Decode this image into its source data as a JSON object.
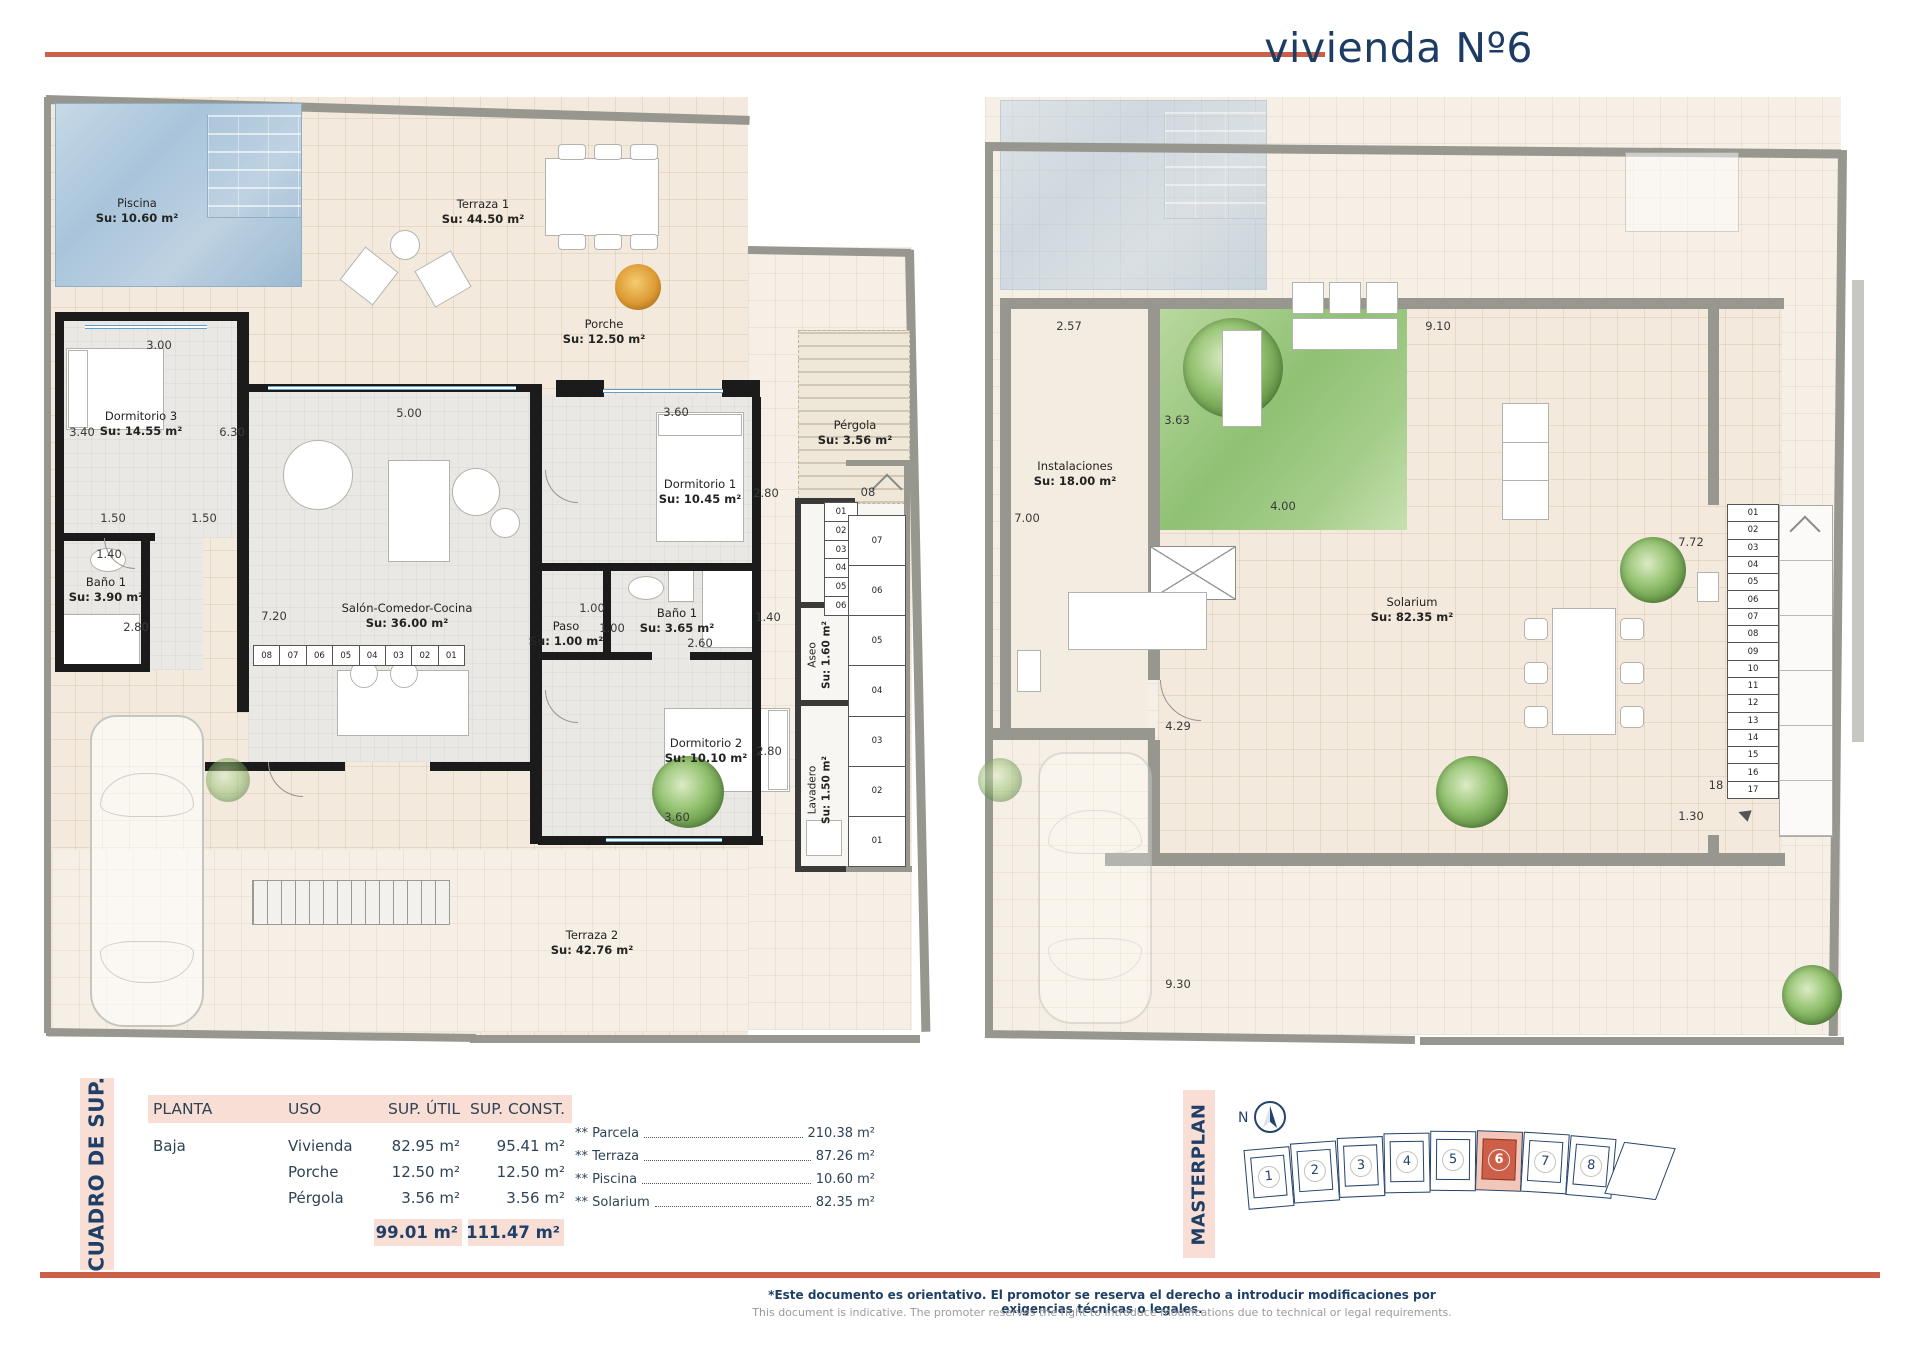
{
  "title": "vivienda Nº6",
  "colors": {
    "accent": "#cc5f48",
    "navy": "#1f3f66",
    "pink": "#f8ded4",
    "pool": "#a9c4da",
    "green": "#8fc173"
  },
  "left_plan": {
    "rooms": [
      {
        "name": "Piscina",
        "area": "Su: 10.60 m²"
      },
      {
        "name": "Terraza 1",
        "area": "Su: 44.50 m²"
      },
      {
        "name": "Porche",
        "area": "Su: 12.50 m²"
      },
      {
        "name": "Dormitorio 3",
        "area": "Su: 14.55 m²"
      },
      {
        "name": "Baño 1",
        "area": "Su: 3.90 m²"
      },
      {
        "name": "Salón-Comedor-Cocina",
        "area": "Su: 36.00 m²"
      },
      {
        "name": "Paso",
        "area": "Su: 1.00 m²"
      },
      {
        "name": "Baño 1",
        "area": "Su: 3.65 m²"
      },
      {
        "name": "Dormitorio 1",
        "area": "Su: 10.45 m²"
      },
      {
        "name": "Dormitorio 2",
        "area": "Su: 10.10 m²"
      },
      {
        "name": "Aseo",
        "area": "Su: 1.60 m²"
      },
      {
        "name": "Lavadero",
        "area": "Su: 1.50 m²"
      },
      {
        "name": "Pérgola",
        "area": "Su: 3.56 m²"
      },
      {
        "name": "Terraza 2",
        "area": "Su: 42.76 m²"
      }
    ],
    "dims": [
      "3.00",
      "3.40",
      "6.30",
      "1.50",
      "1.50",
      "1.40",
      "2.80",
      "7.20",
      "5.00",
      "3.60",
      "2.80",
      "1.00",
      "1.00",
      "2.60",
      "1.40",
      "2.80",
      "3.60",
      "08"
    ],
    "stair_inner": [
      "01",
      "02",
      "03",
      "04",
      "05",
      "06"
    ],
    "stair_outer": [
      "07",
      "06",
      "05",
      "04",
      "03",
      "02",
      "01"
    ],
    "stair_bottom": [
      "08",
      "07",
      "06",
      "05",
      "04",
      "03",
      "02",
      "01"
    ]
  },
  "right_plan": {
    "rooms": [
      {
        "name": "Instalaciones",
        "area": "Su: 18.00 m²"
      },
      {
        "name": "Solarium",
        "area": "Su: 82.35 m²"
      }
    ],
    "dims": [
      "2.57",
      "9.10",
      "3.63",
      "7.00",
      "4.00",
      "7.72",
      "4.29",
      "9.30",
      "1.30",
      "18"
    ],
    "stair_numbers": [
      "01",
      "02",
      "03",
      "04",
      "05",
      "06",
      "07",
      "08",
      "09",
      "10",
      "11",
      "12",
      "13",
      "14",
      "15",
      "16",
      "17"
    ]
  },
  "table": {
    "section_label": "CUADRO DE SUP.",
    "headers": [
      "PLANTA",
      "USO",
      "SUP. ÚTIL",
      "SUP. CONST."
    ],
    "rows": [
      {
        "planta": "Baja",
        "uso": "Vivienda",
        "util": "82.95 m²",
        "cons": "95.41 m²"
      },
      {
        "planta": "",
        "uso": "Porche",
        "util": "12.50 m²",
        "cons": "12.50 m²"
      },
      {
        "planta": "",
        "uso": "Pérgola",
        "util": "3.56 m²",
        "cons": "3.56 m²"
      }
    ],
    "totals": {
      "util": "99.01 m²",
      "cons": "111.47 m²"
    },
    "extras": [
      {
        "label": "** Parcela",
        "value": "210.38 m²"
      },
      {
        "label": "** Terraza",
        "value": "87.26 m²"
      },
      {
        "label": "** Piscina",
        "value": "10.60 m²"
      },
      {
        "label": "** Solarium",
        "value": "82.35 m²"
      }
    ]
  },
  "masterplan": {
    "section_label": "MASTERPLAN",
    "north_label": "N",
    "units": [
      "1",
      "2",
      "3",
      "4",
      "5",
      "6",
      "7",
      "8"
    ],
    "highlighted_unit": "6"
  },
  "footer": {
    "line1": "*Este documento es orientativo. El promotor se reserva el derecho a introducir modificaciones por exigencias técnicas o legales.",
    "line2": "This document is indicative. The promoter reserves the right to introduce modifications due to technical or legal requirements."
  }
}
